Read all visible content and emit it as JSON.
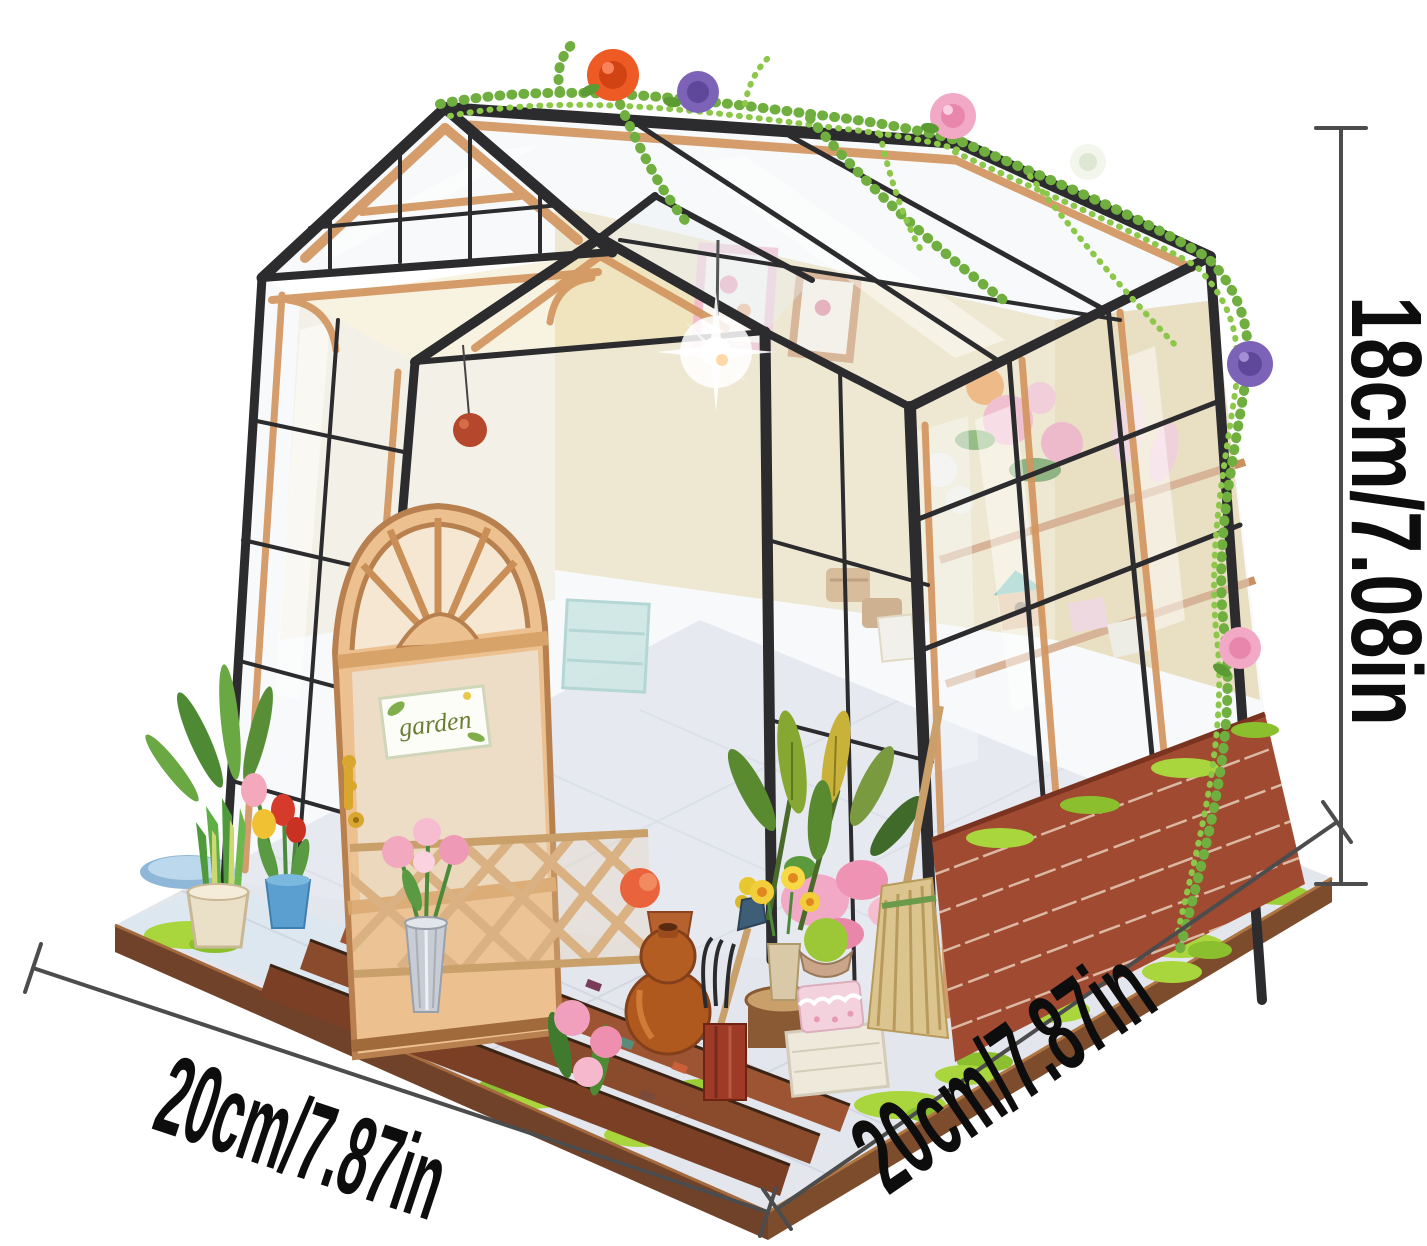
{
  "meta": {
    "description": "Product photo of a DIY miniature wooden greenhouse dollhouse kit (glass flower house with black frame, arched wooden door, flowers, vines and garden props) on a wooden base, annotated with size dimension lines",
    "background": "#ffffff"
  },
  "annotations": {
    "height_label": "18cm/7.08in",
    "bottom_left_label": "20cm/7.87in",
    "bottom_right_label": "20cm/7.87in",
    "line_color": "#4c4c4c",
    "text_color": "#0d0d0d"
  },
  "greenhouse": {
    "door_sign_text": "garden",
    "palette": {
      "frame_black": "#2c2b2e",
      "wood_tan": "#d2955f",
      "wood_light": "#ecc08f",
      "interior_wall": "#f0e3bb",
      "glass_tint": "#e9f0f2",
      "brick_red": "#a04a31",
      "grass_green": "#a8d63c",
      "tile_gray": "#e4e6ed",
      "base_wood": "#70422a",
      "rose_orange": "#ee5a24",
      "rose_purple": "#7d63b8",
      "rose_pink": "#f2a9c6",
      "rose_white": "#f3f6ec",
      "vine_green": "#74ad3f",
      "tulip_red": "#d63a2a",
      "tulip_yellow": "#f0c233",
      "tulip_pink": "#f3a8bc",
      "pot_blue": "#5b9fd0",
      "pot_cream": "#eadfc7",
      "vase_silver": "#c8cdd5",
      "gourd_brown": "#b0591f",
      "broom_straw": "#dcc48e",
      "cake_pink": "#f3d2dd",
      "box_white": "#efe9dc",
      "cup_red": "#9e3a26",
      "tool_blue": "#3e5d77"
    }
  }
}
